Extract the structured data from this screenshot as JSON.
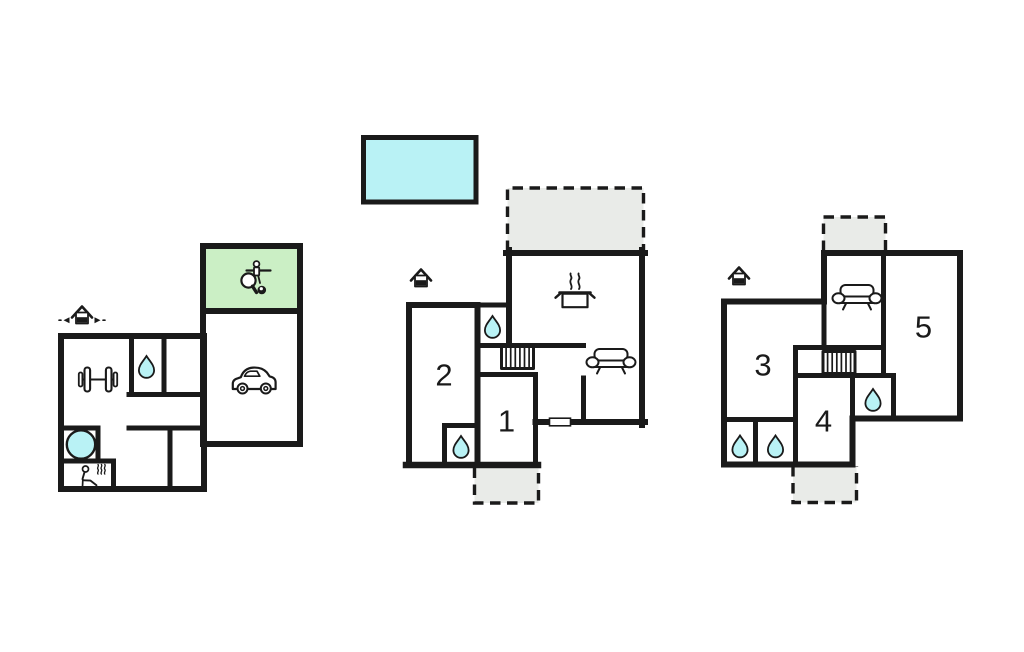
{
  "document": {
    "type": "holiday-home-floor-plan",
    "floors_shown": 3,
    "background": "white"
  },
  "colors": {
    "wall": "#1a1a1a",
    "water_fill": "#b9f2f5",
    "games_room_fill": "#cbefc5",
    "terrace_fill": "#e9ebe8",
    "paper": "#ffffff"
  },
  "rooms": {
    "r1": "1",
    "r2": "2",
    "r3": "3",
    "r4": "4",
    "r5": "5"
  },
  "icons": {
    "entrance": "entrance-house-icon",
    "water": "water-drop-icon",
    "sofa": "sofa-icon",
    "stairs": "stairs-icon",
    "kitchen": "cooking-pot-icon",
    "car": "car-icon",
    "fitness": "barbell-icon",
    "whirlpool": "whirlpool-tub-icon",
    "sauna": "sauna-person-icon",
    "games": "table-tennis-foosball-billiards-icon",
    "pool": "swimming-pool-rect"
  },
  "plans": [
    {
      "id": "left-plan",
      "room_numbers": [],
      "features": [
        "entrance",
        "games-room",
        "garage",
        "fitness",
        "bathroom",
        "whirlpool",
        "sauna"
      ]
    },
    {
      "id": "middle-plan",
      "room_numbers": [
        "1",
        "2"
      ],
      "features": [
        "entrance",
        "terrace-top",
        "terrace-bottom",
        "kitchen",
        "living-room",
        "stairs",
        "bathroom",
        "bathroom"
      ]
    },
    {
      "id": "right-plan",
      "room_numbers": [
        "3",
        "4",
        "5"
      ],
      "features": [
        "entrance",
        "terrace-top",
        "terrace-bottom",
        "lounge",
        "stairs",
        "bathroom",
        "bathroom",
        "bathroom"
      ]
    }
  ]
}
